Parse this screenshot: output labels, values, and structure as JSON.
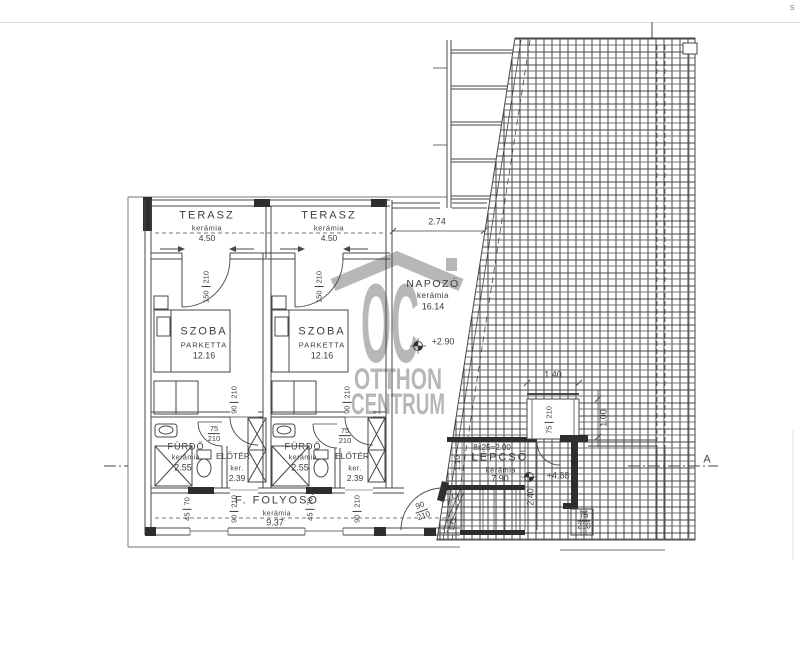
{
  "page": {
    "corner_char": "s"
  },
  "watermark": {
    "logo": "OC",
    "line1": "OTTHON",
    "line2": "CENTRUM",
    "color": "#a6a6a6"
  },
  "rooms": {
    "terasz1": {
      "name": "TERASZ",
      "material": "kerámia",
      "area": "4.50"
    },
    "terasz2": {
      "name": "TERASZ",
      "material": "kerámia",
      "area": "4.50"
    },
    "szoba1": {
      "name": "SZOBA",
      "material": "PARKETTA",
      "area": "12.16"
    },
    "szoba2": {
      "name": "SZOBA",
      "material": "PARKETTA",
      "area": "12.16"
    },
    "furdo1": {
      "name": "FÜRDŐ",
      "material": "kerámia",
      "area": "2.55"
    },
    "furdo2": {
      "name": "FÜRDŐ",
      "material": "kerámia",
      "area": "2.55"
    },
    "eloter1": {
      "name": "ELŐTÉR",
      "material": "ker.",
      "area": "2.39"
    },
    "eloter2": {
      "name": "ELŐTÉR",
      "material": "ker.",
      "area": "2.39"
    },
    "folyoso": {
      "name": "F. FOLYOSÓ",
      "material": "kerámia",
      "area": "9.37"
    },
    "napozo": {
      "name": "NAPOZÓ",
      "material": "kerámia",
      "area": "16.14"
    },
    "lepcso": {
      "name": "LÉPCSŐ",
      "material": "kerámia",
      "area": "7.90"
    }
  },
  "stairs": {
    "formula": "8x25=2.00"
  },
  "levels": {
    "napozo": "+2.90",
    "lepcso": "+4.68"
  },
  "dims": {
    "napozo_width": "2.74",
    "box_width": "1.40",
    "box_height": "1.00",
    "stair_width": "1.10",
    "stair_depth": "2.40"
  },
  "tags": {
    "terasz_door": {
      "w": "150",
      "h": "210"
    },
    "szoba_door": {
      "w": "90",
      "h": "210"
    },
    "furdo_door": {
      "w": "75",
      "h": "210"
    },
    "stair_door": {
      "w": "90",
      "h": "210"
    },
    "roof_opening": {
      "w": "75",
      "h": "210"
    },
    "right_door": {
      "w": "75",
      "h": "210"
    },
    "window": {
      "w": "45",
      "h": "70"
    }
  },
  "section": {
    "label": "A"
  },
  "colors": {
    "line": "#474747",
    "text": "#3d3d3d",
    "watermark": "#a6a6a6"
  }
}
